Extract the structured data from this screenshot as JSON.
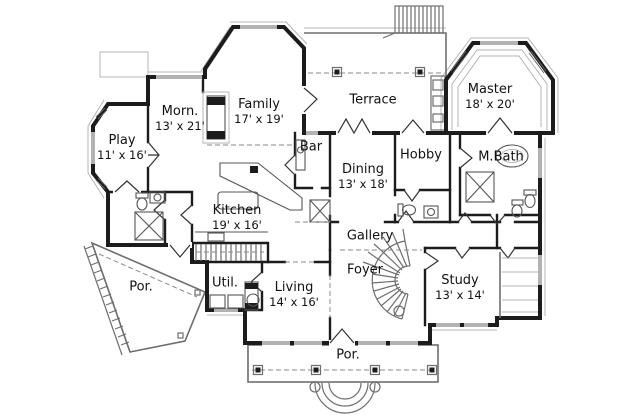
{
  "plan": {
    "type": "first-floor-plan",
    "rooms": {
      "play": {
        "name": "Play",
        "dims": "11' x 16'"
      },
      "morn": {
        "name": "Morn.",
        "dims": "13' x 21'"
      },
      "family": {
        "name": "Family",
        "dims": "17' x 19'"
      },
      "terrace": {
        "name": "Terrace",
        "dims": ""
      },
      "master": {
        "name": "Master",
        "dims": "18' x 20'"
      },
      "bar": {
        "name": "Bar",
        "dims": ""
      },
      "dining": {
        "name": "Dining",
        "dims": "13' x 18'"
      },
      "hobby": {
        "name": "Hobby",
        "dims": ""
      },
      "mbath": {
        "name": "M.Bath",
        "dims": ""
      },
      "kitchen": {
        "name": "Kitchen",
        "dims": "19' x 16'"
      },
      "gallery": {
        "name": "Gallery",
        "dims": ""
      },
      "foyer": {
        "name": "Foyer",
        "dims": ""
      },
      "por_left": {
        "name": "Por.",
        "dims": ""
      },
      "util": {
        "name": "Util.",
        "dims": ""
      },
      "living": {
        "name": "Living",
        "dims": "14' x 16'"
      },
      "study": {
        "name": "Study",
        "dims": "13' x 14'"
      },
      "por_bottom": {
        "name": "Por.",
        "dims": ""
      }
    },
    "colors": {
      "wall": "#1c1c1c",
      "line": "#6e6e6e",
      "light": "#b4b4b4",
      "background": "#ffffff",
      "text": "#111111"
    }
  }
}
